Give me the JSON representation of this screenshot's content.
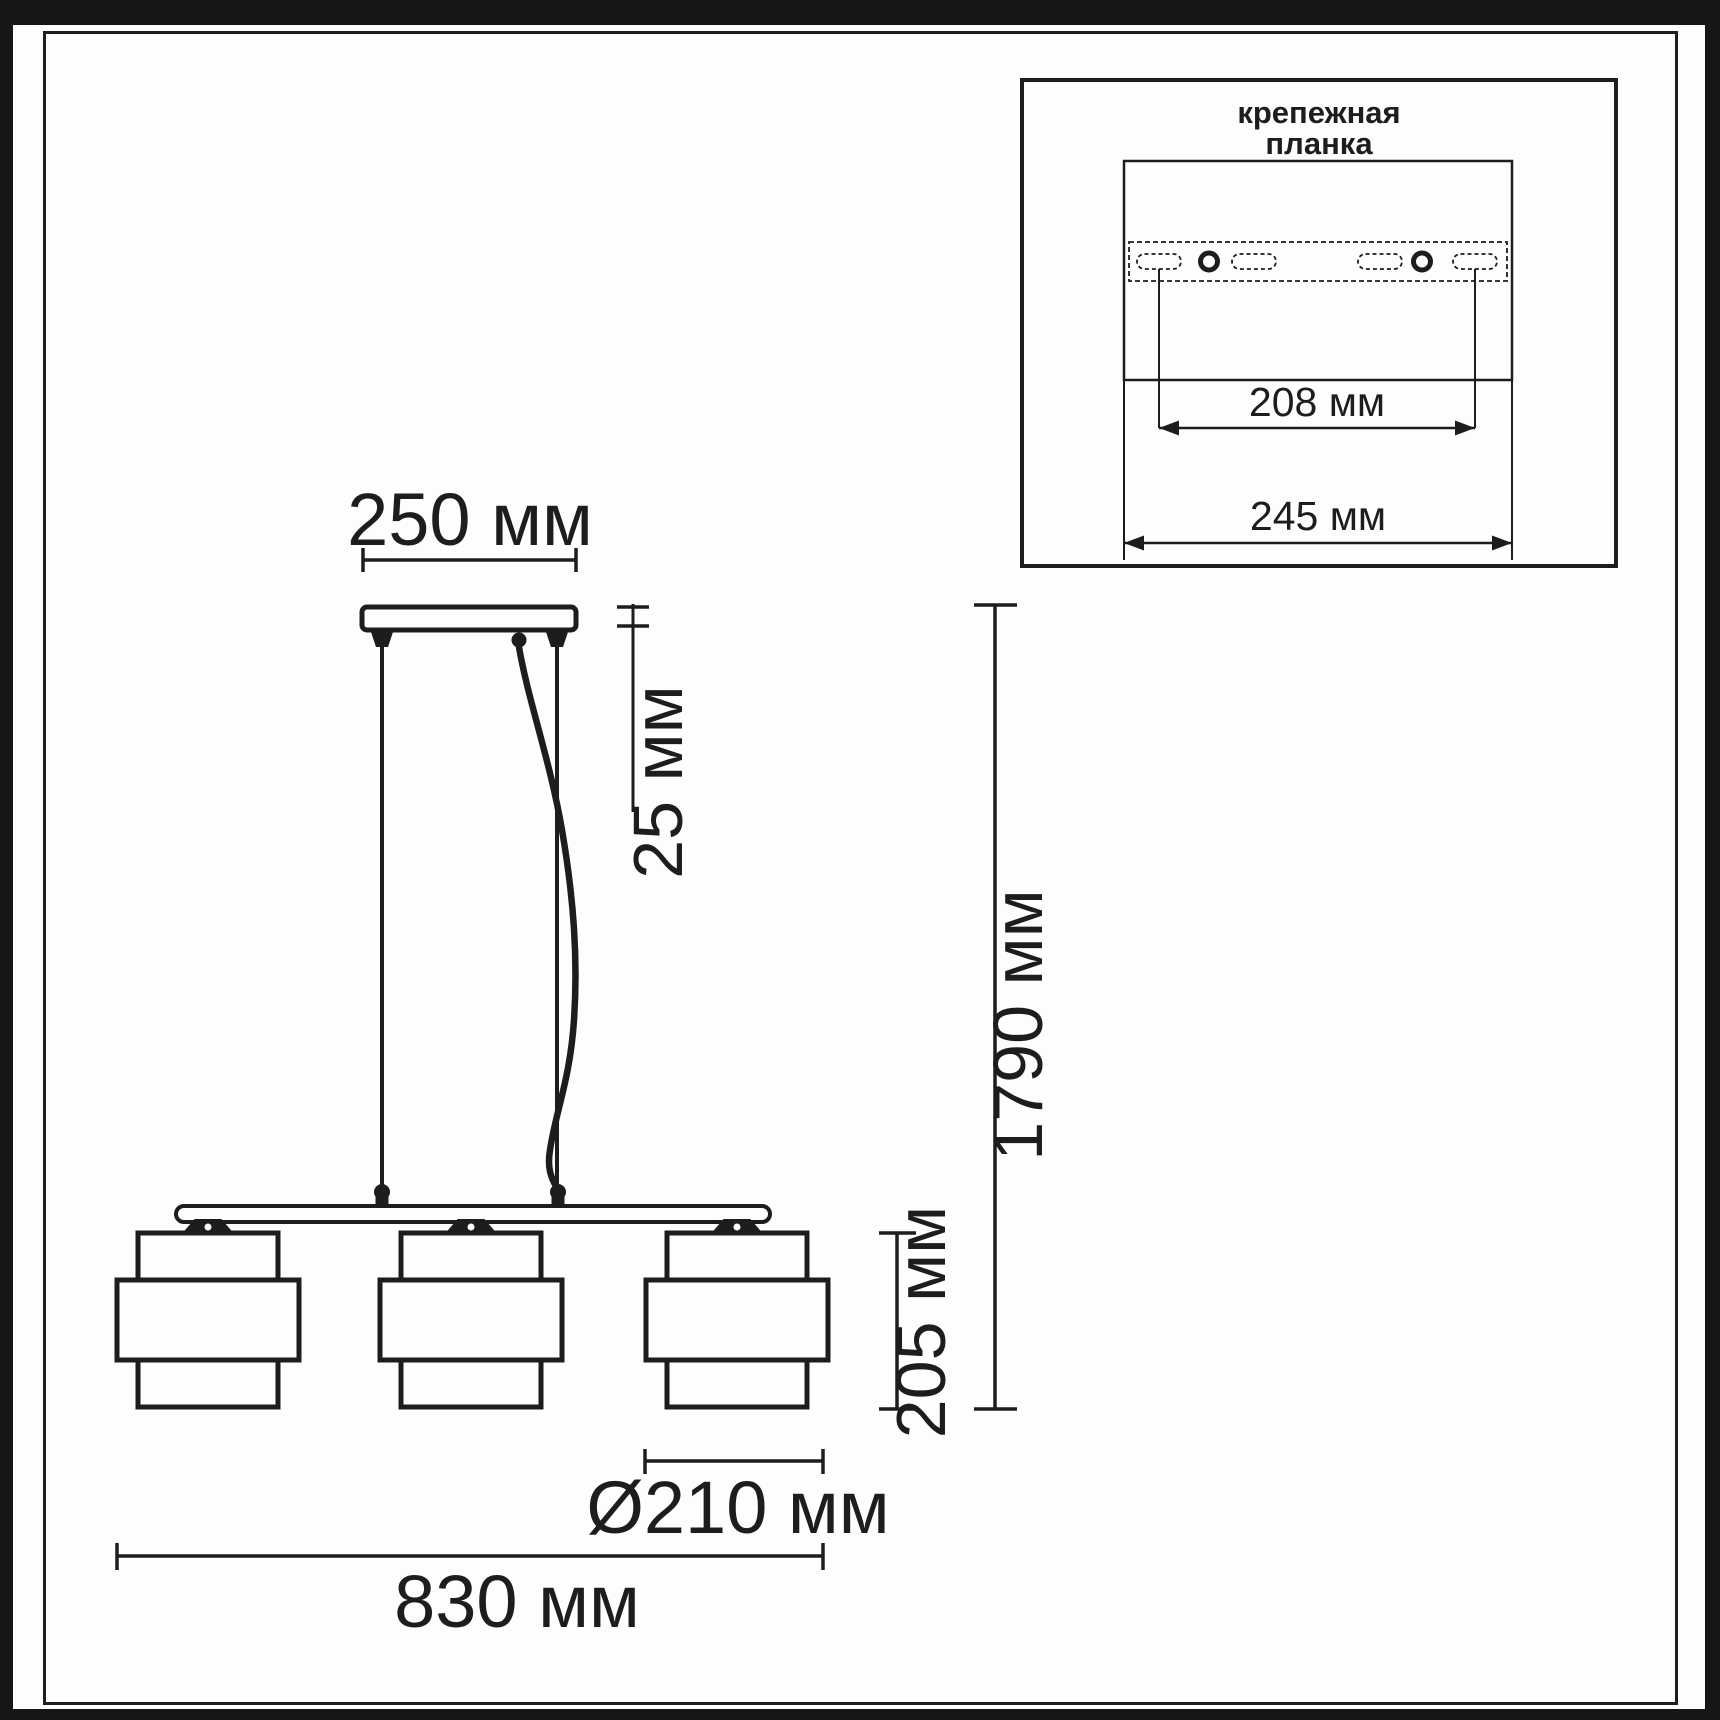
{
  "drawing": {
    "dim_canopy_width": "250 мм",
    "dim_canopy_height": "25 мм",
    "dim_total_height": "1790 мм",
    "dim_shade_height": "205 мм",
    "dim_shade_diameter": "Ø210 мм",
    "dim_fixture_length": "830 мм"
  },
  "mounting_plate_inset": {
    "label_line1": "крепежная",
    "label_line2": "планка",
    "dim_hole_spacing": "208 мм",
    "dim_plate_length": "245 мм"
  },
  "colors": {
    "ink": "#1d1d1d",
    "paper": "#ffffff"
  }
}
